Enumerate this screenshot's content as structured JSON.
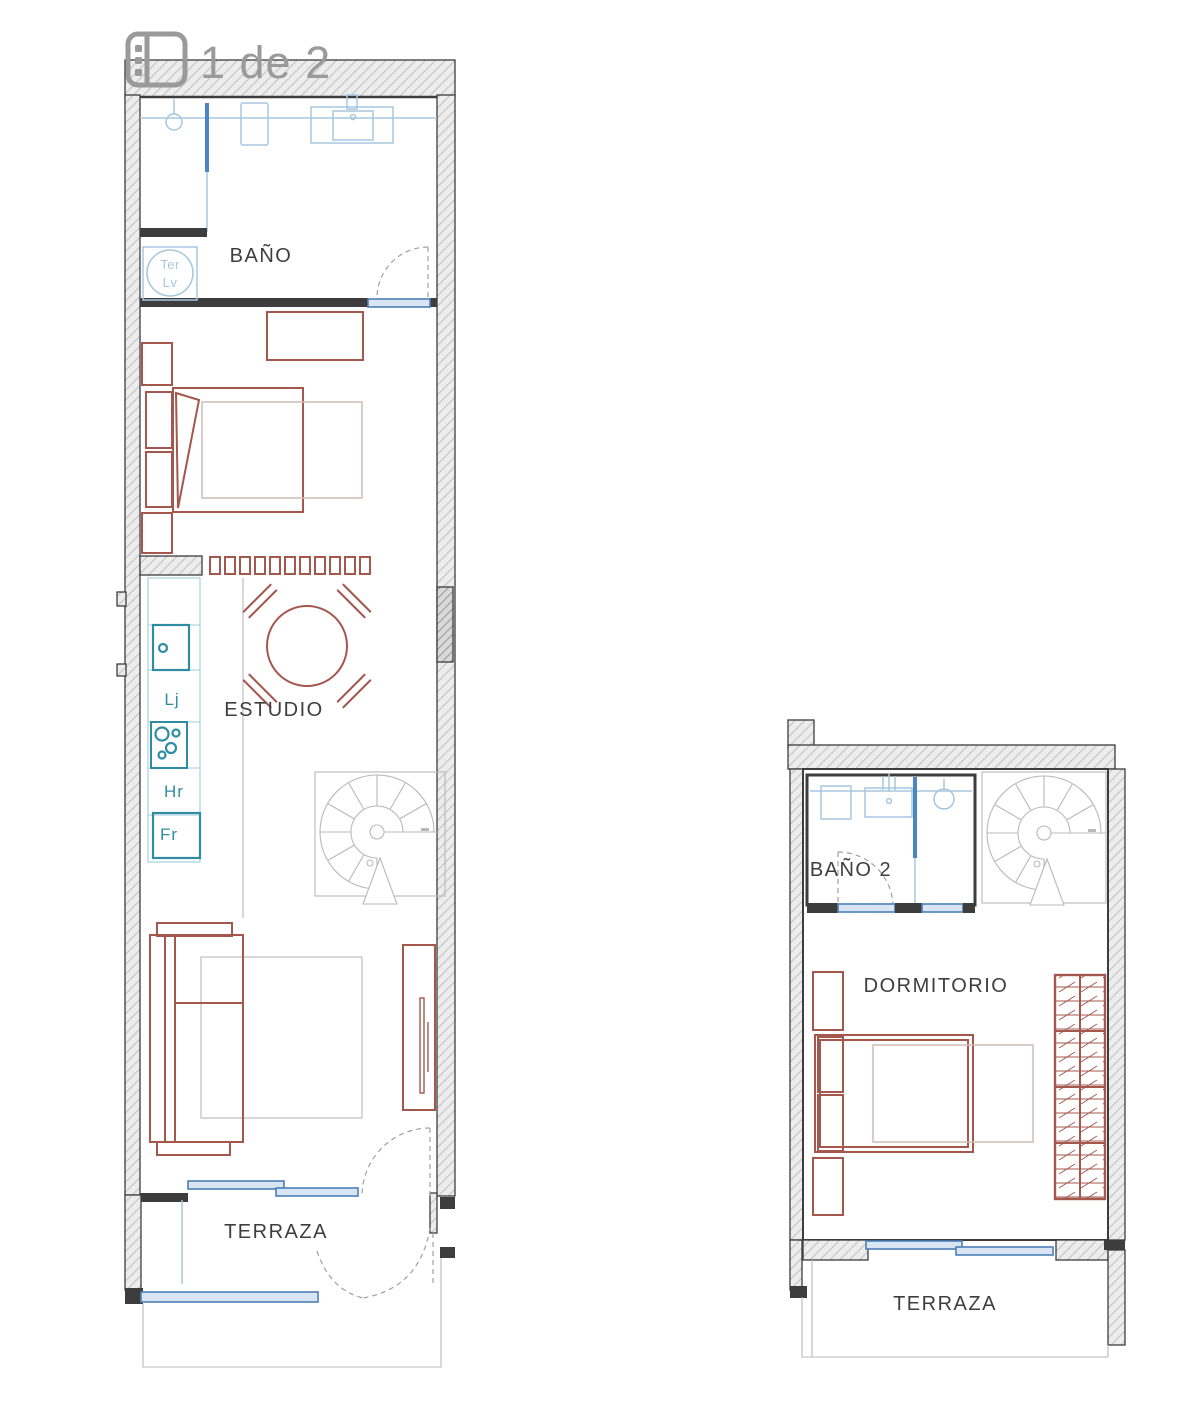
{
  "viewer": {
    "counter_label": "1 de 2",
    "icon": "gallery-icon"
  },
  "colors": {
    "wall_line": "#3d3d3d",
    "furniture_red": "#a3574d",
    "furniture_red_light": "#cfbcb6",
    "fixture_blue": "#a7c7dd",
    "fixture_blue_bold": "#4c86c2",
    "appliance_teal": "#2f8da3",
    "counter_edge": "#9fcdd8",
    "window_frame": "#4c7fb8",
    "window_fill": "#d9e5f2",
    "stair_gray": "#b9b9b9",
    "door_arc": "#a0a0a0",
    "label_gray": "#3e3e3e",
    "counter_gray": "#9a9a9a"
  },
  "plan_lower": {
    "rooms": {
      "bathroom": {
        "label": "BAÑO"
      },
      "studio": {
        "label": "ESTUDIO"
      },
      "terrace": {
        "label": "TERRAZA"
      }
    },
    "kitchen": {
      "washer_line1": "Ter",
      "washer_line2": "Lv",
      "dishwasher": "Lj",
      "oven": "Hr",
      "fridge": "Fr"
    }
  },
  "plan_upper": {
    "rooms": {
      "bathroom2": {
        "label": "BAÑO 2"
      },
      "bedroom": {
        "label": "DORMITORIO"
      },
      "terrace": {
        "label": "TERRAZA"
      }
    }
  }
}
